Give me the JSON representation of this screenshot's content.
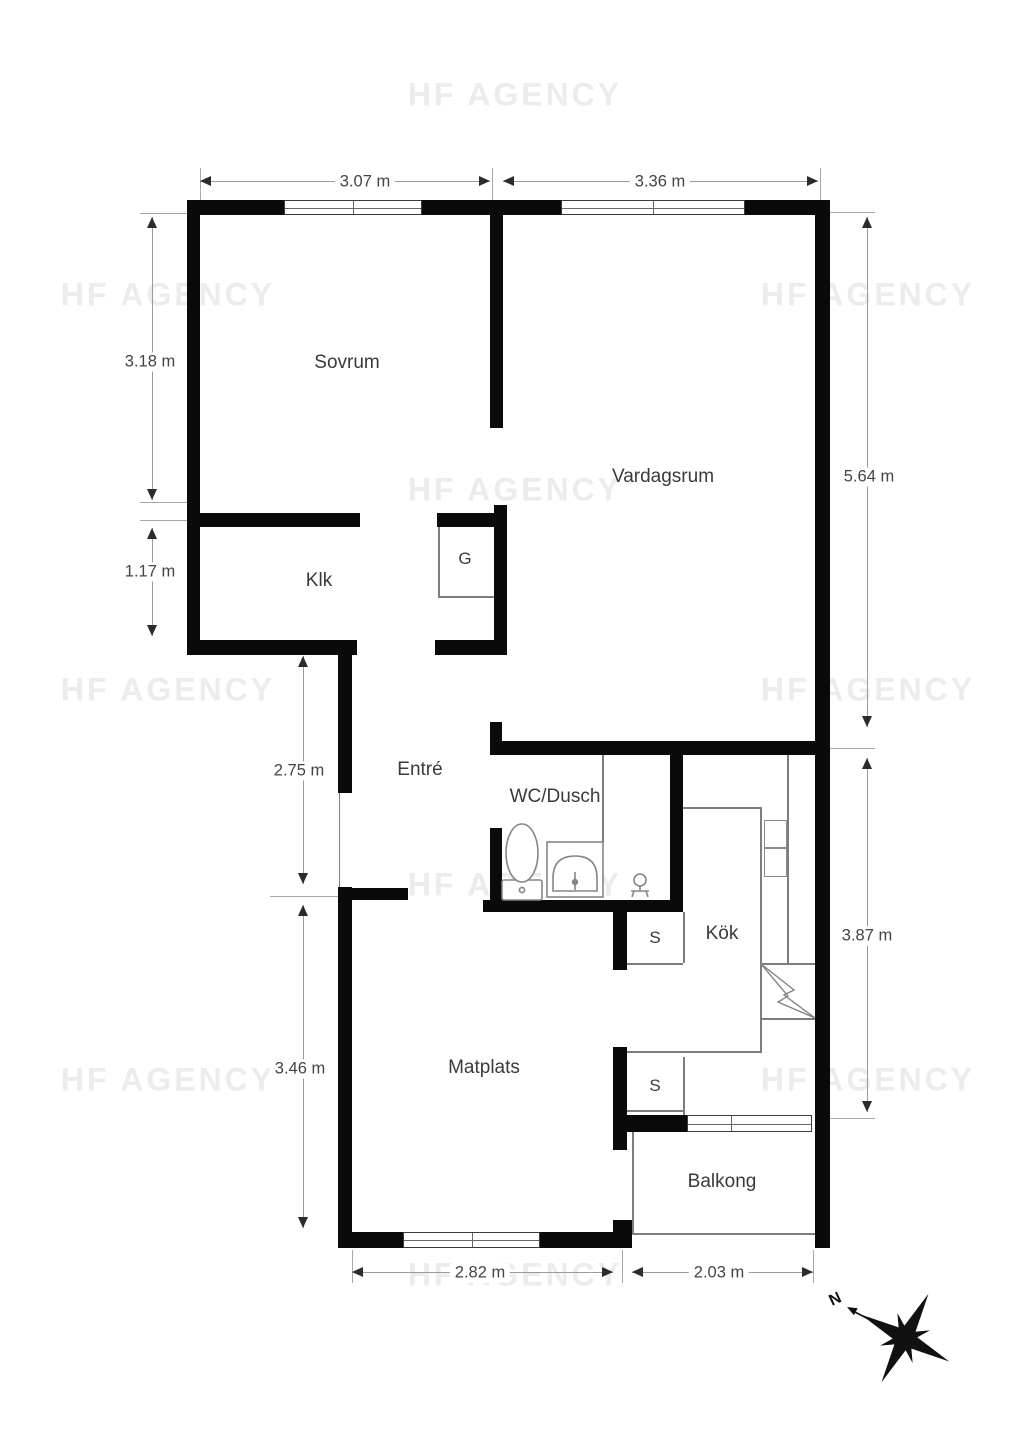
{
  "watermark": {
    "text": "HF AGENCY"
  },
  "rooms": {
    "sovrum": "Sovrum",
    "vardagsrum": "Vardagsrum",
    "klk": "Klk",
    "garderob": "G",
    "entre": "Entré",
    "wc_dusch": "WC/Dusch",
    "kok": "Kök",
    "closet_s1": "S",
    "matplats": "Matplats",
    "closet_s2": "S",
    "balkong": "Balkong"
  },
  "dimensions": {
    "top_left": "3.07 m",
    "top_right": "3.36 m",
    "left_upper": "3.18 m",
    "left_lower": "1.17 m",
    "right_upper": "5.64 m",
    "right_lower": "3.87 m",
    "inner_upper": "2.75 m",
    "inner_lower": "3.46 m",
    "bottom_left": "2.82 m",
    "bottom_right": "2.03 m"
  },
  "compass": {
    "north_label": "N"
  },
  "colors": {
    "wall": "#0a0a0a",
    "thin_line": "#7d7d7d",
    "dimension_line": "#9a9a9a",
    "arrow": "#2b2b2b",
    "label_text": "#3a3a3a",
    "watermark": "#ececec",
    "background": "#ffffff"
  }
}
